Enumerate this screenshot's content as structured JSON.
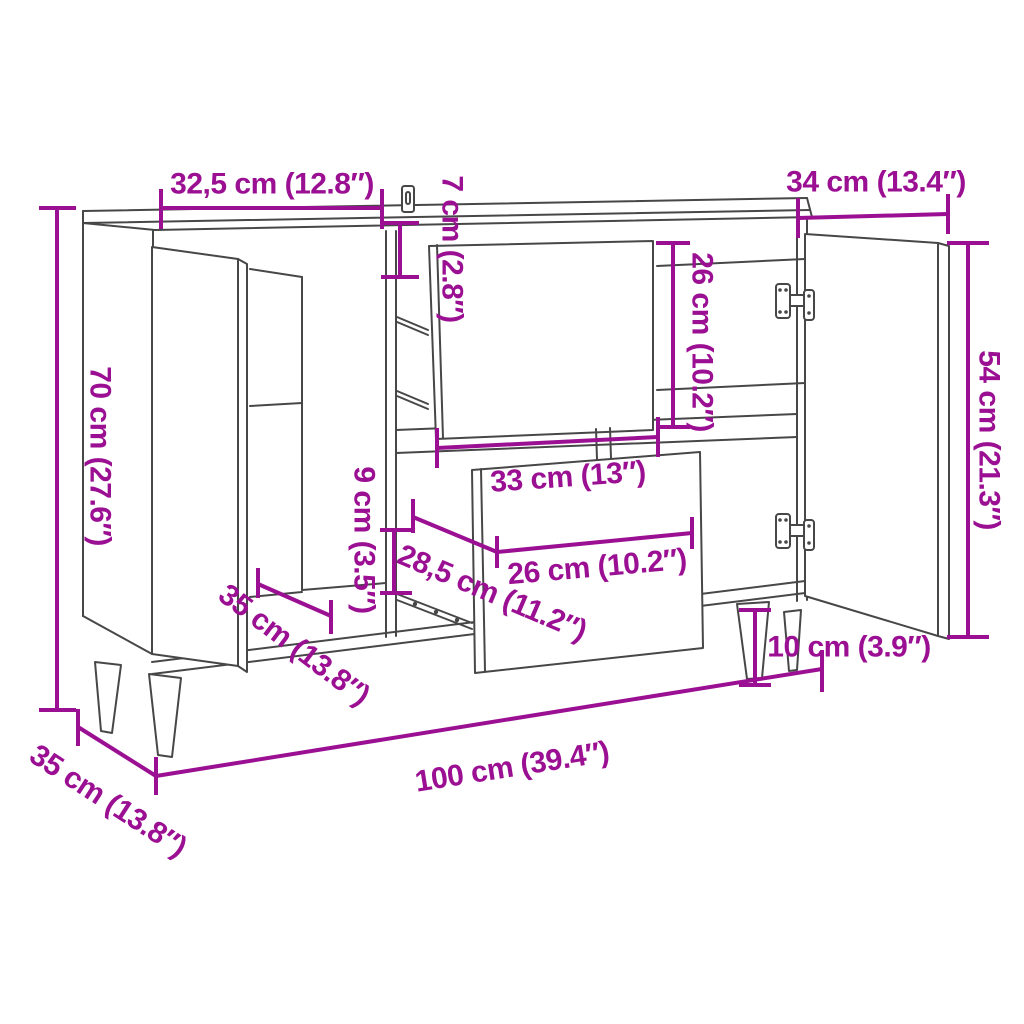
{
  "title": "Sideboard dimension diagram",
  "colors": {
    "dimension_accent": "#9B0F93",
    "line_art": "#474747",
    "background": "#FFFFFF"
  },
  "dims": {
    "left_section_width": "32,5 cm (12.8″)",
    "top_rail_height": "7 cm (2.8″)",
    "right_door_width": "34 cm (13.4″)",
    "overall_height": "70 cm (27.6″)",
    "drawer_front_height": "26 cm (10.2″)",
    "door_height": "54 cm (21.3″)",
    "drawer_opening_width": "33 cm (13″)",
    "base_clearance": "9 cm (3.5″)",
    "drawer_depth": "28,5 cm (11.2″)",
    "drawer_inner_width": "26 cm (10.2″)",
    "compartment_depth": "35 cm (13.8″)",
    "leg_height": "10 cm (3.9″)",
    "overall_depth": "35 cm (13.8″)",
    "overall_width": "100 cm (39.4″)"
  },
  "icons": {
    "hinge": "cabinet-hinge",
    "wall_anchor": "anti-tip wall bracket"
  }
}
